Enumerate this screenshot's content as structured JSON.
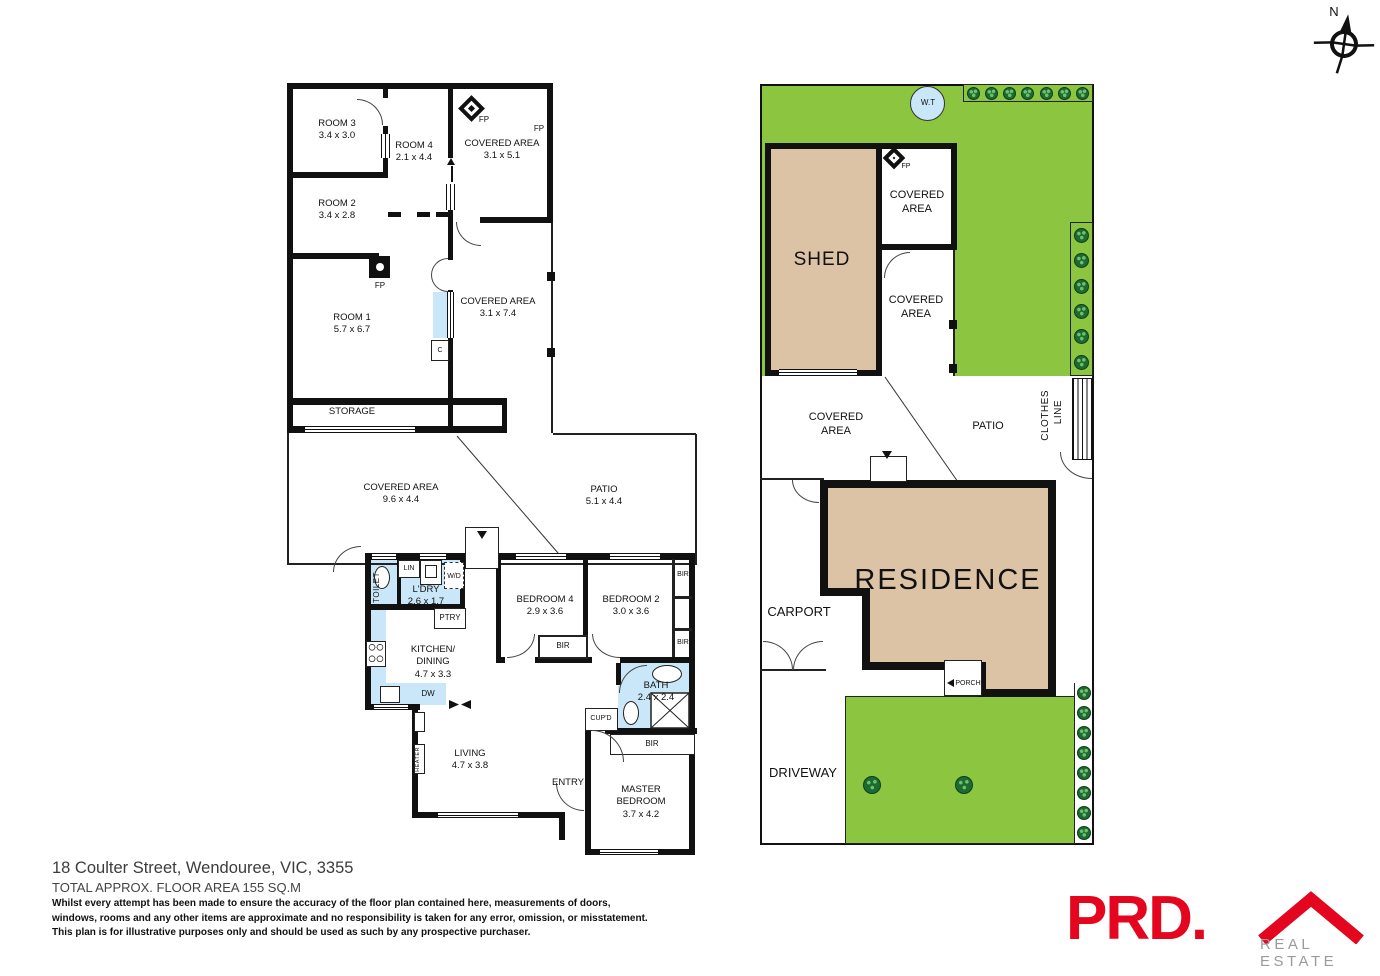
{
  "colors": {
    "wall": "#111111",
    "grass": "#8cc540",
    "tree": "#1e6b31",
    "building_fill": "#ddc3a5",
    "wet_area": "#c9e7f8",
    "brand_red": "#e4051f",
    "brand_gray": "#9a9a9a"
  },
  "compass": {
    "north": "N"
  },
  "outbuilding": {
    "room3": {
      "name": "ROOM 3",
      "dims": "3.4 x 3.0"
    },
    "room4": {
      "name": "ROOM 4",
      "dims": "2.1 x 4.4"
    },
    "room2": {
      "name": "ROOM 2",
      "dims": "3.4 x 2.8"
    },
    "room1": {
      "name": "ROOM 1",
      "dims": "5.7 x 6.7"
    },
    "covered_top": {
      "name": "COVERED AREA",
      "dims": "3.1 x 5.1"
    },
    "covered_side": {
      "name": "COVERED AREA",
      "dims": "3.1 x 7.4"
    },
    "storage": "STORAGE",
    "fp_diamond": "FP",
    "fp_corner": "FP",
    "fp_room1": "FP",
    "cupboard": "C"
  },
  "deck": {
    "covered": {
      "name": "COVERED AREA",
      "dims": "9.6 x 4.4"
    },
    "patio": {
      "name": "PATIO",
      "dims": "5.1 x 4.4"
    }
  },
  "house": {
    "toilet": "TOILET",
    "lin": "LIN",
    "wd": "W/D",
    "ldry": {
      "name": "L'DRY",
      "dims": "2.6 x 1.7"
    },
    "ptry": "PTRY",
    "kitchen": {
      "name": "KITCHEN/",
      "name2": "DINING",
      "dims": "4.7 x 3.3"
    },
    "dw": "DW",
    "bedroom4": {
      "name": "BEDROOM 4",
      "dims": "2.9 x 3.6"
    },
    "bedroom2": {
      "name": "BEDROOM 2",
      "dims": "3.0 x 3.6"
    },
    "bir_right_top": "BIR",
    "bir_right_mid": "BIR",
    "bir_hall": "BIR",
    "bir_master": "BIR",
    "bath": {
      "name": "BATH",
      "dims": "2.4 x 2.4"
    },
    "cupd": "CUP'D",
    "living": {
      "name": "LIVING",
      "dims": "4.7 x 3.8"
    },
    "heater": "HEATER",
    "entry": "ENTRY",
    "master": {
      "name": "MASTER",
      "name2": "BEDROOM",
      "dims": "3.7 x 4.2"
    }
  },
  "site": {
    "wt": "W.T",
    "shed": "SHED",
    "fp": "FP",
    "covered_upper": {
      "line1": "COVERED",
      "line2": "AREA"
    },
    "covered_lower": {
      "line1": "COVERED",
      "line2": "AREA"
    },
    "covered_mid": {
      "line1": "COVERED",
      "line2": "AREA"
    },
    "patio": "PATIO",
    "clothes_line1": "CLOTHES",
    "clothes_line2": "LINE",
    "residence": "RESIDENCE",
    "carport": "CARPORT",
    "porch": "PORCH",
    "driveway": "DRIVEWAY"
  },
  "footer": {
    "address": "18 Coulter Street, Wendouree, VIC, 3355",
    "floor_area": "TOTAL APPROX. FLOOR AREA 155 SQ.M",
    "disclaimer_1": "Whilst every attempt has been made to ensure the accuracy of the floor plan contained here, measurements of doors,",
    "disclaimer_2": "windows, rooms and any other items are approximate and no responsibility is taken for any error, omission, or misstatement.",
    "disclaimer_3": "This plan is for illustrative purposes only and should be used as such by any prospective purchaser."
  },
  "brand": {
    "name": "PRD.",
    "tagline": "REAL ESTATE"
  }
}
